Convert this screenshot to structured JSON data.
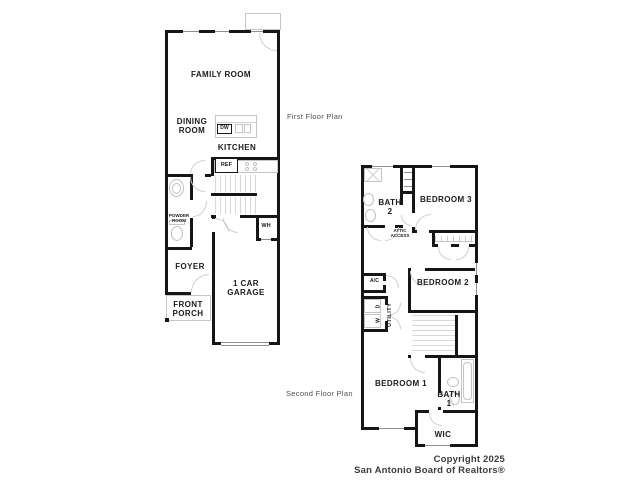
{
  "first_floor": {
    "caption": "First Floor Plan",
    "labels": {
      "family_room": "FAMILY ROOM",
      "dining_room": "DINING\nROOM",
      "kitchen": "KITCHEN",
      "dishwasher": "DW",
      "refrigerator": "REF",
      "powder_room": "POWDER\nROOM",
      "water_heater": "WH",
      "foyer": "FOYER",
      "garage": "1 CAR GARAGE",
      "front_porch": "FRONT\nPORCH"
    }
  },
  "second_floor": {
    "caption": "Second Floor Plan",
    "labels": {
      "bath_2": "BATH\n2",
      "bedroom_3": "BEDROOM 3",
      "attic_access": "ATTIC\nACCESS",
      "ac": "A/C",
      "dryer": "D",
      "washer": "W",
      "utility": "UTILITY",
      "bedroom_2": "BEDROOM 2",
      "bedroom_1": "BEDROOM 1",
      "bath_1": "BATH\n1",
      "wic": "WIC"
    }
  },
  "footer": {
    "line1": "Copyright 2025",
    "line2": "San Antonio Board of Realtors®"
  },
  "colors": {
    "wall": "#161616",
    "fixture_line": "#c4c4c4",
    "caption_text": "#4f4f4f",
    "footer_text": "#3c3c3c",
    "background": "#ffffff"
  }
}
